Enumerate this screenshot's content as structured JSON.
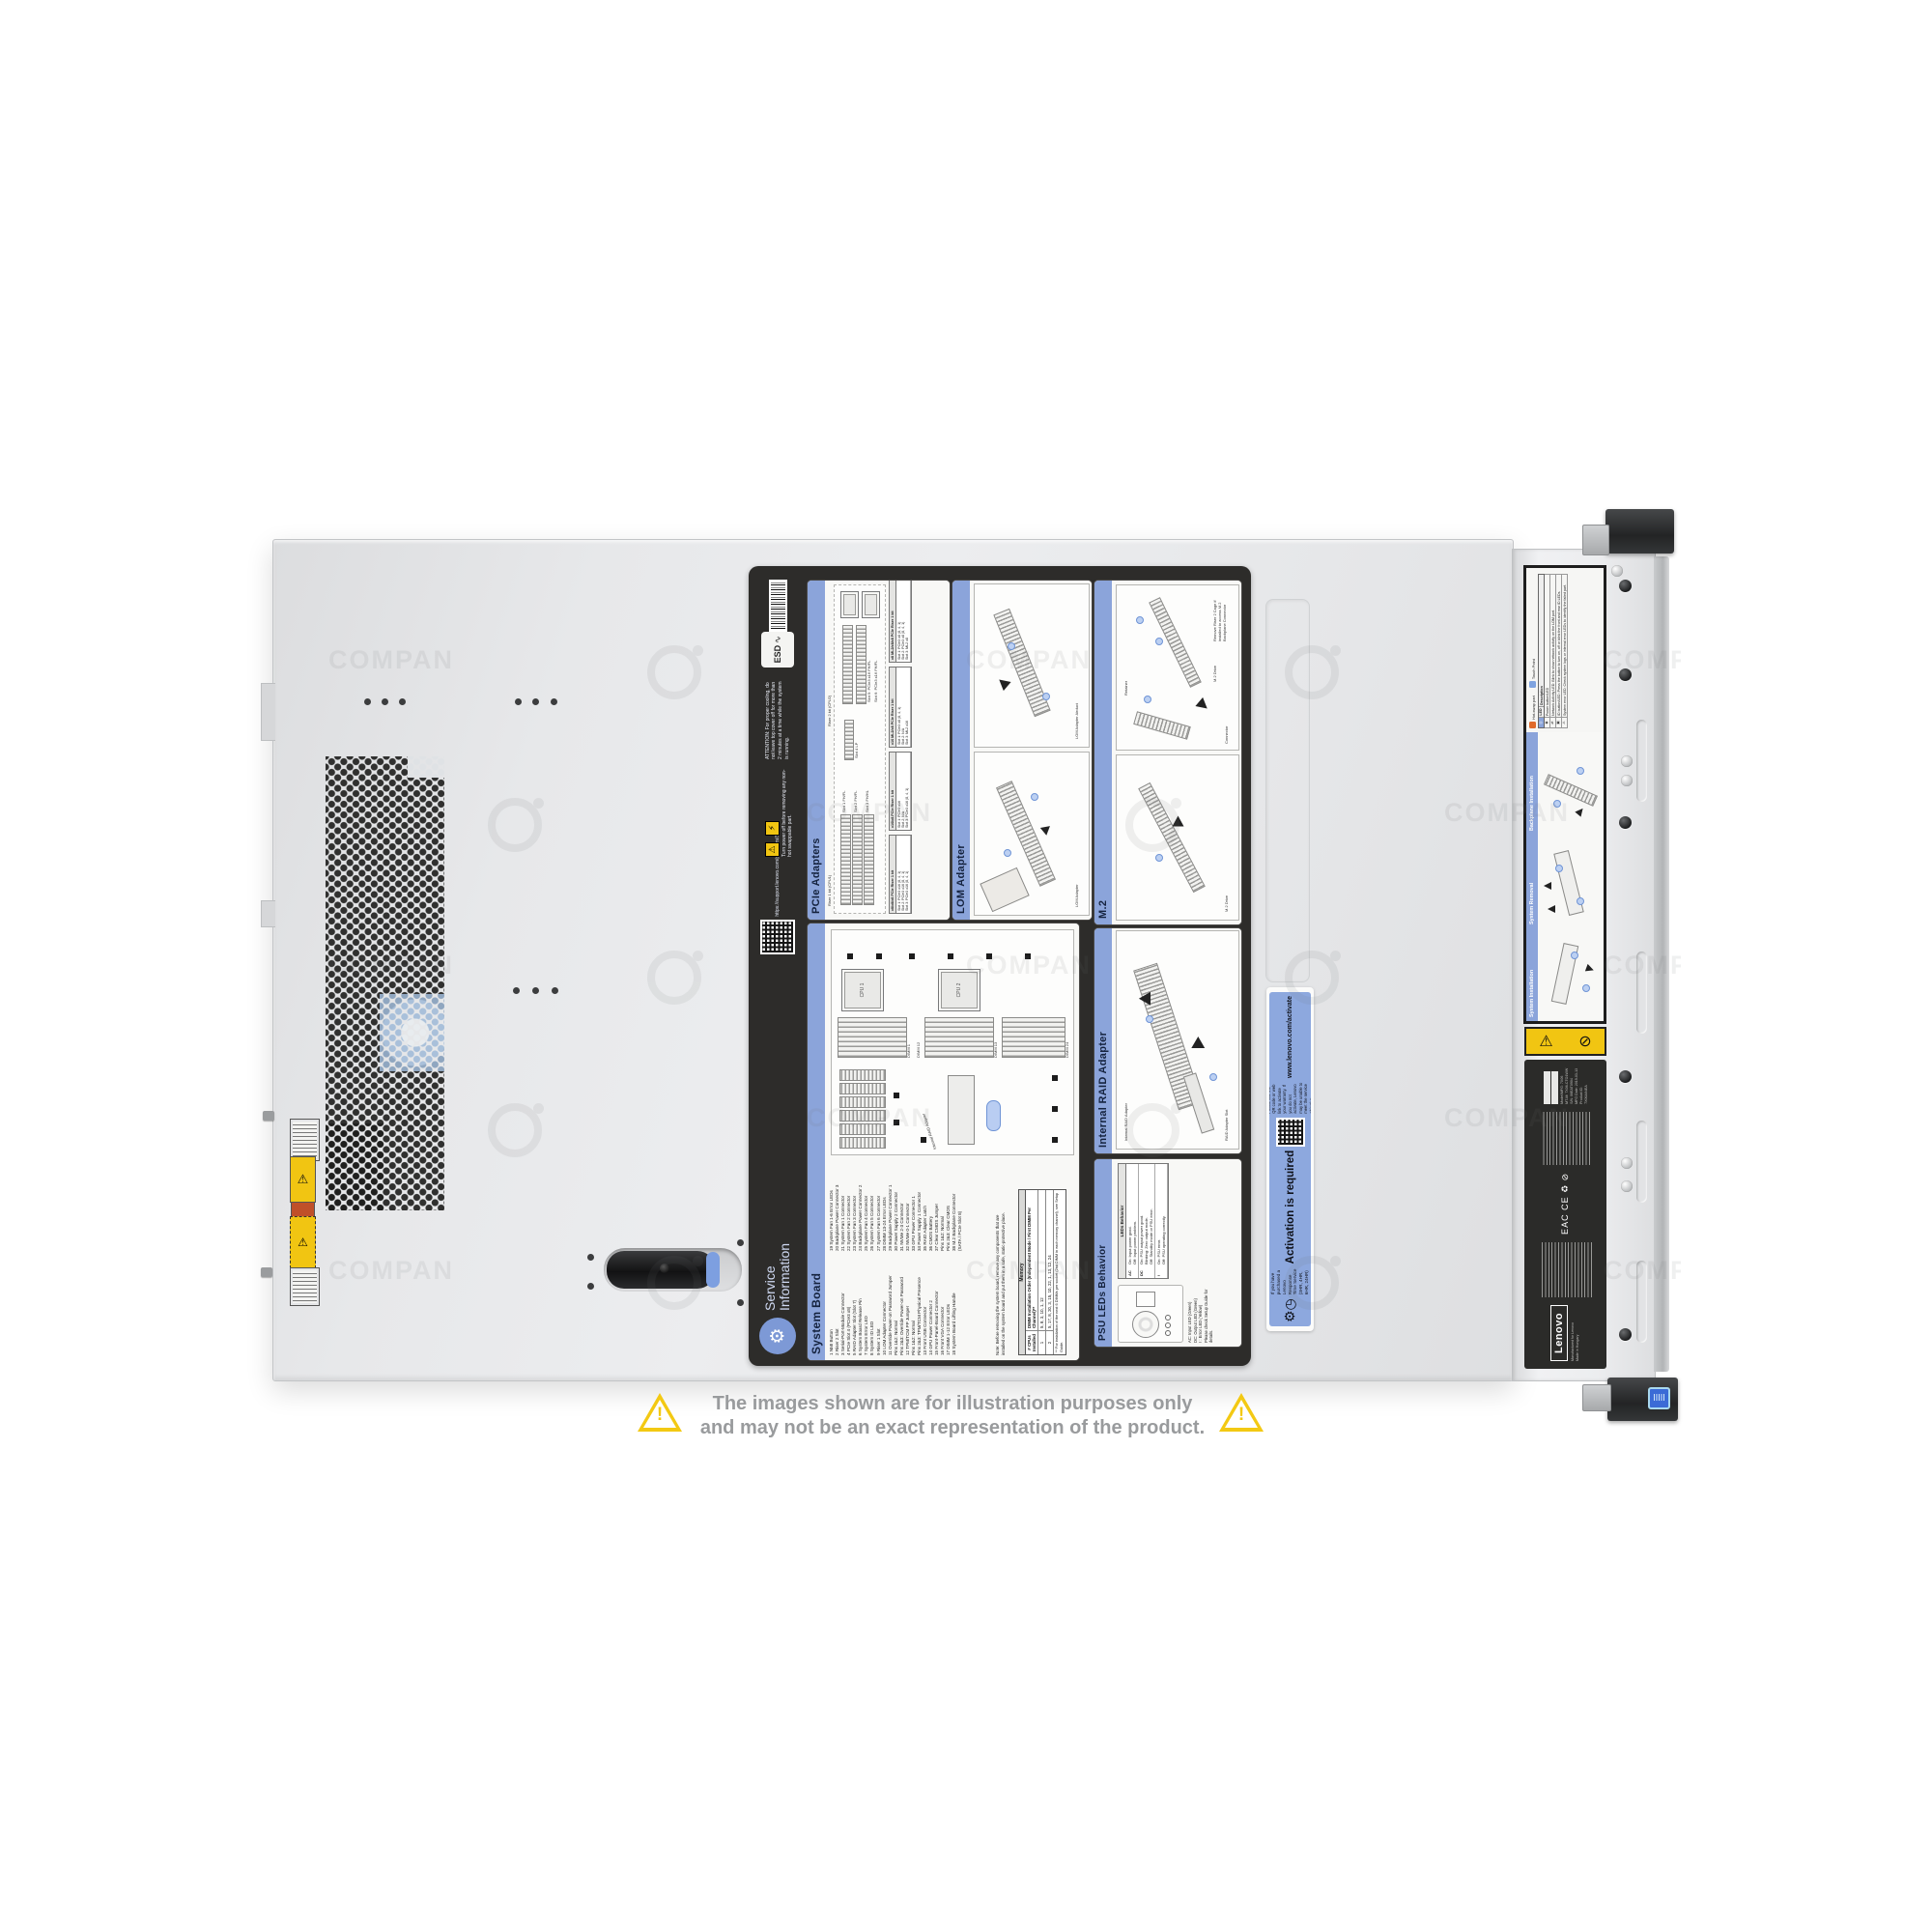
{
  "watermark": {
    "text": "COMPAN"
  },
  "disclaimer": {
    "line1": "The images shown are for illustration purposes only",
    "line2": "and may not be an exact representation of the product."
  },
  "service_label": {
    "title_line1": "Service",
    "title_line2": "Information",
    "esd": "ESD",
    "attention": "ATTENTION: For proper cooling, do not leave top cover off for more than 2 minutes at a time while the system is running.",
    "power_off": "Turn power off before removing any non-hot swappable part.",
    "qr_caption": "https://support.lenovo.com/p/servers/SR650",
    "panels": {
      "pcie": {
        "title": "PCIe Adapters",
        "riser1_label": "Riser 1 kit (CPU1)",
        "riser2_label": "Riser 2 kit (CPU2)",
        "slots": [
          "Slot 1 FH/FL",
          "Slot 2 FH/FL",
          "Slot 3 FH/HL",
          "Slot 4 LP",
          "Slot 5: PCIe3 x16 FH/FL",
          "Slot 6: PCIe3 x16 FH/FL"
        ],
        "tables": [
          {
            "title": "x8/x8/x8 PCIe Riser 1 kit",
            "rows": [
              "Slot 1: PCIe3 x16 (8, 4, 1)",
              "Slot 2: PCIe3 x16 (8, 4, 1)",
              "Slot 3: PCIe3 x16 (8, 4, 1)"
            ]
          },
          {
            "title": "x16/x8 PCIe Riser 1 kit",
            "rows": [
              "Slot 1: PCIe3 x16",
              "Slot 2: N/A",
              "Slot 3: PCIe3 x16 (8, 4, 1)"
            ]
          },
          {
            "title": "x16 ML2/x8 PCIe Riser 1 kit",
            "rows": [
              "Slot 1: PCIe3 x8 (8, 4, 1)",
              "Slot 2: N/A",
              "Slot 3: ML2 x16"
            ]
          },
          {
            "title": "x8 ML2/x8/x8 PCIe Riser 1 kit",
            "rows": [
              "Slot 1: PCIe3 x8 (8, 4, 1)",
              "Slot 2: PCIe3 x8 (8, 4, 1)",
              "Slot 3: ML2 x8"
            ]
          }
        ]
      },
      "lom": {
        "title": "LOM Adapter",
        "labels": [
          "LOM Adapter Airduct",
          "LOM Adapter"
        ]
      },
      "m2": {
        "title": "M.2",
        "labels": [
          "M.2 Drive",
          "Retainer",
          "Connector",
          "M.2 Drive"
        ],
        "note": "Remove Riser 2 Cage if installed to access M.2 Backplane Connector"
      },
      "system_board": {
        "title": "System Board",
        "legend_left": [
          "1 NMI Button",
          "2 Riser 2 Slot",
          "3 Serial-Port-Module Connector",
          "4 PCIe Slot 4 (PCIe3 x8)",
          "5 RAID Adapter Slot (Slot 7)",
          "6 System Board Release Pin",
          "7 System Error LED",
          "8 System ID LED",
          "9 Riser 1 Slot",
          "10 LOM Adapter Connector",
          "11 Override Power-on Password Jumper",
          "     Pins 1&2: Normal",
          "     Pins 2&3: Override Power-on Password",
          "12 TPM/TCM PP Jumper",
          "     Pins 1&2: Normal",
          "     Pins 2&3: TPM/TCM Physical Presence",
          "13 Front USB Connector",
          "14 GPU Power Connector 2",
          "15 Front-Panel-Board Connector",
          "16 Front VGA Connector",
          "17 DIMM 1-12 Error LEDs",
          "18 System Board Lifting Handle"
        ],
        "legend_right": [
          "19 System Fan 1-6 Error LEDs",
          "20 Backplane Power Connector 3",
          "21 System Fan 1 Connector",
          "22 System Fan 2 Connector",
          "23 System Fan 3 Connector",
          "24 Backplane Power Connector 2",
          "25 System Fan 4 Connector",
          "26 System Fan 5 Connector",
          "27 System Fan 6 Connector",
          "28 DIMM 13-24 Error LEDs",
          "29 Backplane Power Connector 1",
          "30 Power Supply 2 Connector",
          "31 NVMe 2-3 Connector",
          "32 NVMe 0-1 Connector",
          "33 GPU Power Connector 1",
          "34 Power Supply 1 Connector",
          "35 RAID Adapter Latch",
          "36 CMOS Battery",
          "37 Clear CMOS Jumper",
          "     Pins 1&2: Normal",
          "     Pins 2&3: Clear CMOS",
          "38 M.2 Backplane Connector",
          "     (SATA / PCIe Slot 8)"
        ],
        "note": "Note: Before removing the system board, remove any components that are installed on the system board and put them in a safe, static-protective place.",
        "diagram": {
          "cpu1": "CPU 1",
          "cpu2": "CPU 2",
          "raid": "Internal RAID Adapter",
          "dimm_labels": [
            "DIMM 1",
            "DIMM 12",
            "DIMM 13",
            "DIMM 24"
          ]
        },
        "memory": {
          "title": "Memory",
          "col_cpus": "# CPUs Installed",
          "col_order": "DIMM Installation Order (Independent Mode / First DIMM Per Channel)**",
          "r1_cpus": "1",
          "r1_order": "5, 8, 3, 10, 1, 12",
          "r2_cpus": "2",
          "r2_order": "5, 17, 8, 20, 3, 15, 10, 22, 1, 13, 12, 24",
          "footnote": "** For installation of the next 6 DIMMs per socket (2nd DIMM in each memory channel), see Setup Guide."
        }
      },
      "raid": {
        "title": "Internal RAID Adapter",
        "labels": [
          "Internal RAID Adapter",
          "RAID Adapter Slot"
        ]
      },
      "psu": {
        "title": "PSU LEDs Behavior",
        "legend": [
          "AC: Input LED (Green)",
          "DC: Output LED (Green)",
          "!  : Error LED (Yellow)",
          "Please check Setup Guide for details."
        ],
        "table_title": "LEDs Behavior",
        "rows": [
          {
            "k": "AC",
            "v": "On: Input power good.\nOff: Input power problem."
          },
          {
            "k": "DC",
            "v": "On: PSU output power good.\nBlinking: Zero output mode.\nOff: Standby mode or PSU error."
          },
          {
            "k": "!",
            "v": "On: PSU error.\nOff: PSU operating correctly."
          }
        ]
      }
    }
  },
  "activation_label": {
    "intro": "If you have purchased a Lenovo Response Time Service (3HR, 4HR, 6HR, 24HR)",
    "heading": "Activation is required",
    "body": "Please use the QR code or web link to activate your warranty. If you do not activate, Lenovo may be unable to meet the service objective",
    "url": "www.lenovo.com/activate"
  },
  "front_label": {
    "hot_swap": "Hot-swap part",
    "touch_point": "Touch Point",
    "col_led": "LED",
    "col_desc": "Description",
    "led_rows": [
      "Power button/LED",
      "Network Activity LED: Blink to show network activity on the LOM port.",
      "ID button/LED: Press the button to turn on, off or blink the front and rear ID LEDs.",
      "System error LED: Check system logs or internal error LEDs to identify the failed part."
    ],
    "sections": [
      "Backplane Installation",
      "System Removal",
      "System Installation"
    ]
  },
  "reg_label": {
    "brand": "Lenovo",
    "made": "Manufactured for Lenovo\nMade in Hungary",
    "certs": "EAC   CE   ♻   ⊘",
    "info": [
      "Model/MFG: 7X06",
      "MT-M: 7X06-CTO1WW",
      "S/N: 06EAT0904",
      "MFG Date: 2019-03-13",
      "Product ID: 7X06A04EA"
    ]
  }
}
